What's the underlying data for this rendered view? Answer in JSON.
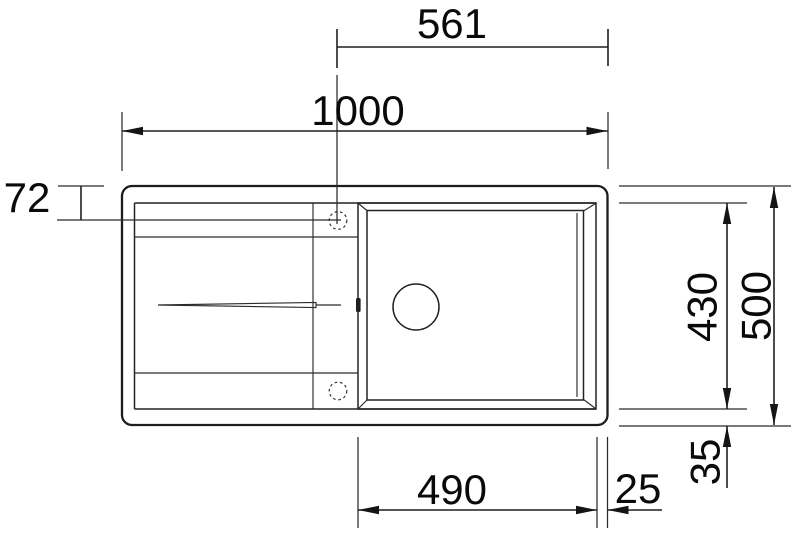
{
  "colors": {
    "background": "#ffffff",
    "line": "#1d1d1d",
    "text": "#0a0a0a"
  },
  "dimensions": {
    "tap_center_to_right_edge": "561",
    "overall_width": "1000",
    "top_edge_to_tap_center": "72",
    "bowl_depth": "430",
    "overall_depth": "500",
    "bowl_bottom_to_edge": "35",
    "bowl_width": "490",
    "bowl_right_to_edge": "25"
  }
}
